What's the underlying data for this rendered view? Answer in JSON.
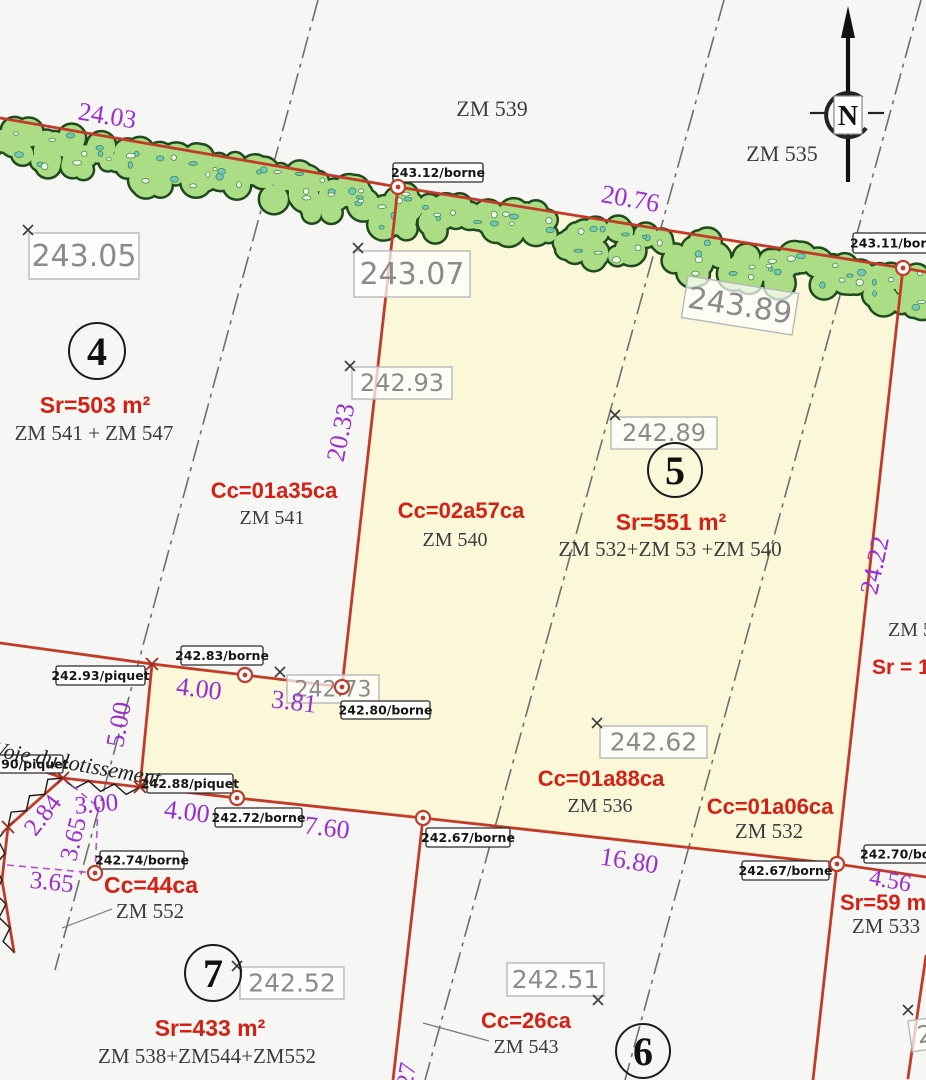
{
  "title": "Plan de division cadastrale",
  "colors": {
    "background": "#f6f6f4",
    "parcel_fill": "#fbf8da",
    "boundary_red": "#c23b28",
    "area_red": "#d42114",
    "dimension_purple": "#992ed2",
    "dash_gray": "#6f6f6f",
    "hedge_fill": "#abdc86",
    "hedge_outline": "#1f4a1d",
    "hedge_speck_light": "#e9f8e2",
    "hedge_speck_teal": "#6fc9bd",
    "elev_box_stroke": "#b8b8b8",
    "elev_text": "#8b8b8b"
  },
  "north": {
    "label": "N"
  },
  "road_label": {
    "text": "Voie du lotissement",
    "x": -8,
    "y": 756,
    "rot": 10,
    "fs": 22
  },
  "parcel_numbers": [
    {
      "n": "4",
      "x": 97,
      "y": 351,
      "r": 28
    },
    {
      "n": "5",
      "x": 675,
      "y": 470,
      "r": 27
    },
    {
      "n": "6",
      "x": 643,
      "y": 1051,
      "r": 27
    },
    {
      "n": "7",
      "x": 213,
      "y": 973,
      "r": 28
    }
  ],
  "area_labels": [
    {
      "text": "Sr=503 m²",
      "x": 95,
      "y": 413,
      "fs": 23
    },
    {
      "text": "Cc=01a35ca",
      "x": 274,
      "y": 498,
      "fs": 22
    },
    {
      "text": "Cc=02a57ca",
      "x": 461,
      "y": 518,
      "fs": 22
    },
    {
      "text": "Sr=551 m²",
      "x": 671,
      "y": 530,
      "fs": 23
    },
    {
      "text": "Cc=01a88ca",
      "x": 601,
      "y": 786,
      "fs": 22
    },
    {
      "text": "Cc=01a06ca",
      "x": 770,
      "y": 814,
      "fs": 22
    },
    {
      "text": "Cc=44ca",
      "x": 151,
      "y": 893,
      "fs": 23
    },
    {
      "text": "Sr=433 m²",
      "x": 210,
      "y": 1036,
      "fs": 23
    },
    {
      "text": "Cc=26ca",
      "x": 526,
      "y": 1028,
      "fs": 22
    },
    {
      "text": "Sr=59 m²",
      "x": 840,
      "y": 910,
      "fs": 22,
      "anchor": "start"
    },
    {
      "text": "Sr = 1",
      "x": 872,
      "y": 674,
      "fs": 21,
      "anchor": "start"
    }
  ],
  "zm_labels": [
    {
      "text": "ZM 539",
      "x": 492,
      "y": 116,
      "fs": 22
    },
    {
      "text": "ZM 535",
      "x": 782,
      "y": 161,
      "fs": 22
    },
    {
      "text": "ZM 541 + ZM 547",
      "x": 94,
      "y": 440,
      "fs": 21
    },
    {
      "text": "ZM 541",
      "x": 272,
      "y": 524,
      "fs": 20
    },
    {
      "text": "ZM 540",
      "x": 455,
      "y": 546,
      "fs": 20
    },
    {
      "text": "ZM 532+ZM 53 +ZM 540",
      "x": 670,
      "y": 556,
      "fs": 21
    },
    {
      "text": "ZM 536",
      "x": 600,
      "y": 812,
      "fs": 20
    },
    {
      "text": "ZM 532",
      "x": 769,
      "y": 838,
      "fs": 21
    },
    {
      "text": "ZM 552",
      "x": 150,
      "y": 918,
      "fs": 21
    },
    {
      "text": "ZM 538+ZM544+ZM552",
      "x": 207,
      "y": 1063,
      "fs": 21
    },
    {
      "text": "ZM 543",
      "x": 526,
      "y": 1053,
      "fs": 20
    },
    {
      "text": "ZM 533",
      "x": 886,
      "y": 933,
      "fs": 21
    },
    {
      "text": "ZM 5",
      "x": 888,
      "y": 636,
      "fs": 20,
      "anchor": "start"
    }
  ],
  "dimensions": [
    {
      "text": "24.03",
      "x": 106,
      "y": 124,
      "rot": 9,
      "fs": 26
    },
    {
      "text": "20.76",
      "x": 629,
      "y": 207,
      "rot": 10,
      "fs": 26
    },
    {
      "text": "20.33",
      "x": 349,
      "y": 434,
      "rot": -79,
      "fs": 26
    },
    {
      "text": "24.22",
      "x": 883,
      "y": 567,
      "rot": -78,
      "fs": 26
    },
    {
      "text": "4.00",
      "x": 198,
      "y": 697,
      "rot": 7,
      "fs": 26
    },
    {
      "text": "3.81",
      "x": 293,
      "y": 710,
      "rot": 7,
      "fs": 26
    },
    {
      "text": "5.00",
      "x": 127,
      "y": 726,
      "rot": -80,
      "fs": 26
    },
    {
      "text": "4.00",
      "x": 186,
      "y": 820,
      "rot": 7,
      "fs": 26
    },
    {
      "text": "7.60",
      "x": 326,
      "y": 836,
      "rot": 7,
      "fs": 26
    },
    {
      "text": "16.80",
      "x": 628,
      "y": 869,
      "rot": 9,
      "fs": 26
    },
    {
      "text": "4.56",
      "x": 889,
      "y": 888,
      "rot": 10,
      "fs": 24
    },
    {
      "text": "2.84",
      "x": 49,
      "y": 820,
      "rot": -52,
      "fs": 25
    },
    {
      "text": "3.00",
      "x": 97,
      "y": 812,
      "rot": -5,
      "fs": 25
    },
    {
      "text": "3.65",
      "x": 81,
      "y": 841,
      "rot": -76,
      "fs": 25
    },
    {
      "text": "3.65",
      "x": 51,
      "y": 890,
      "rot": 6,
      "fs": 25
    },
    {
      "text": "27",
      "x": 414,
      "y": 1076,
      "rot": -80,
      "fs": 24
    }
  ],
  "elevation_boxes": [
    {
      "text": "243.05",
      "x": 29,
      "y": 233,
      "w": 110,
      "h": 46,
      "fs": 30,
      "rot": 0
    },
    {
      "text": "243.07",
      "x": 354,
      "y": 251,
      "w": 116,
      "h": 46,
      "fs": 30,
      "rot": 0
    },
    {
      "text": "243.89",
      "x": 688,
      "y": 276,
      "w": 112,
      "h": 42,
      "fs": 30,
      "rot": 9
    },
    {
      "text": "242.93",
      "x": 352,
      "y": 367,
      "w": 100,
      "h": 32,
      "fs": 24,
      "rot": 0
    },
    {
      "text": "242.89",
      "x": 611,
      "y": 417,
      "w": 106,
      "h": 32,
      "fs": 24,
      "rot": 0
    },
    {
      "text": "242.73",
      "x": 287,
      "y": 675,
      "w": 92,
      "h": 28,
      "fs": 22,
      "rot": 0
    },
    {
      "text": "242.62",
      "x": 600,
      "y": 726,
      "w": 107,
      "h": 32,
      "fs": 25,
      "rot": 0
    },
    {
      "text": "242.52",
      "x": 240,
      "y": 967,
      "w": 104,
      "h": 32,
      "fs": 25,
      "rot": 0
    },
    {
      "text": "242.51",
      "x": 507,
      "y": 963,
      "w": 97,
      "h": 33,
      "fs": 25,
      "rot": 0
    },
    {
      "text": "242",
      "x": 908,
      "y": 1021,
      "w": 60,
      "h": 31,
      "fs": 24,
      "rot": -8
    }
  ],
  "marker_boxes": [
    {
      "text": "243.12/borne",
      "x": 393,
      "y": 163,
      "w": 90,
      "h": 19
    },
    {
      "text": "243.11/borne",
      "x": 853,
      "y": 233,
      "w": 88,
      "h": 20
    },
    {
      "text": "242.93/piquet",
      "x": 56,
      "y": 666,
      "w": 89,
      "h": 19
    },
    {
      "text": "242.83/borne",
      "x": 181,
      "y": 646,
      "w": 82,
      "h": 19
    },
    {
      "text": "242.80/borne",
      "x": 341,
      "y": 701,
      "w": 89,
      "h": 18
    },
    {
      "text": "242.90/piquet",
      "x": -24,
      "y": 755,
      "w": 87,
      "h": 18
    },
    {
      "text": "242.88/piquet",
      "x": 147,
      "y": 774,
      "w": 86,
      "h": 19
    },
    {
      "text": "242.72/borne",
      "x": 215,
      "y": 808,
      "w": 87,
      "h": 19
    },
    {
      "text": "242.67/borne",
      "x": 426,
      "y": 828,
      "w": 84,
      "h": 19
    },
    {
      "text": "242.74/borne",
      "x": 100,
      "y": 851,
      "w": 84,
      "h": 18
    },
    {
      "text": "242.70/borne",
      "x": 864,
      "y": 845,
      "w": 86,
      "h": 18
    },
    {
      "text": "242.67/borne",
      "x": 742,
      "y": 861,
      "w": 87,
      "h": 19
    }
  ],
  "markers": {
    "bornes": [
      [
        398,
        187
      ],
      [
        903,
        268
      ],
      [
        245,
        675
      ],
      [
        342,
        687
      ],
      [
        237,
        798
      ],
      [
        423,
        818
      ],
      [
        837,
        864
      ],
      [
        95,
        873
      ]
    ],
    "piquet_crosses": [
      [
        152,
        664
      ],
      [
        140,
        787
      ],
      [
        63,
        778
      ],
      [
        8,
        827
      ]
    ],
    "elevation_crosses": [
      [
        28,
        230
      ],
      [
        358,
        248
      ],
      [
        350,
        366
      ],
      [
        615,
        415
      ],
      [
        280,
        672
      ],
      [
        597,
        723
      ],
      [
        237,
        966
      ],
      [
        598,
        1000
      ],
      [
        908,
        1010
      ]
    ]
  },
  "geometry": {
    "parcel_fill_polygon": [
      [
        398,
        187
      ],
      [
        903,
        268
      ],
      [
        837,
        864
      ],
      [
        423,
        818
      ],
      [
        237,
        798
      ],
      [
        140,
        787
      ],
      [
        152,
        664
      ],
      [
        245,
        675
      ],
      [
        342,
        687
      ]
    ],
    "red_polylines": [
      [
        [
          0,
          118
        ],
        [
          398,
          187
        ],
        [
          903,
          268
        ],
        [
          926,
          272
        ]
      ],
      [
        [
          398,
          187
        ],
        [
          342,
          687
        ]
      ],
      [
        [
          903,
          268
        ],
        [
          837,
          864
        ],
        [
          813,
          1080
        ]
      ],
      [
        [
          140,
          787
        ],
        [
          237,
          798
        ],
        [
          423,
          818
        ],
        [
          837,
          864
        ],
        [
          926,
          877
        ]
      ],
      [
        [
          152,
          664
        ],
        [
          140,
          787
        ]
      ],
      [
        [
          342,
          687
        ],
        [
          245,
          675
        ],
        [
          152,
          664
        ]
      ],
      [
        [
          0,
          643
        ],
        [
          152,
          664
        ]
      ],
      [
        [
          0,
          756
        ],
        [
          63,
          778
        ]
      ],
      [
        [
          63,
          778
        ],
        [
          8,
          827
        ],
        [
          2,
          880
        ],
        [
          14,
          952
        ]
      ],
      [
        [
          63,
          778
        ],
        [
          140,
          787
        ]
      ],
      [
        [
          423,
          818
        ],
        [
          393,
          1080
        ]
      ],
      [
        [
          926,
          956
        ],
        [
          908,
          1078
        ]
      ]
    ],
    "dashdot_lines": [
      [
        [
          318,
          0
        ],
        [
          55,
          970
        ]
      ],
      [
        [
          724,
          0
        ],
        [
          425,
          1080
        ]
      ],
      [
        [
          921,
          0
        ],
        [
          625,
          1080
        ]
      ]
    ],
    "purple_dashed": [
      [
        [
          63,
          778
        ],
        [
          98,
          807
        ]
      ],
      [
        [
          98,
          807
        ],
        [
          95,
          873
        ]
      ],
      [
        [
          7,
          865
        ],
        [
          95,
          873
        ]
      ]
    ],
    "leaders": [
      [
        [
          489,
          1041
        ],
        [
          423,
          1023
        ]
      ],
      [
        [
          112,
          909
        ],
        [
          62,
          928
        ]
      ]
    ],
    "zigzags": [
      [
        [
          63,
          778
        ],
        [
          140,
          787
        ]
      ],
      [
        [
          63,
          778
        ],
        [
          8,
          827
        ],
        [
          2,
          880
        ],
        [
          14,
          952
        ]
      ]
    ],
    "hedge_baseline": [
      [
        -14,
        118
      ],
      [
        398,
        187
      ],
      [
        940,
        274
      ]
    ]
  }
}
